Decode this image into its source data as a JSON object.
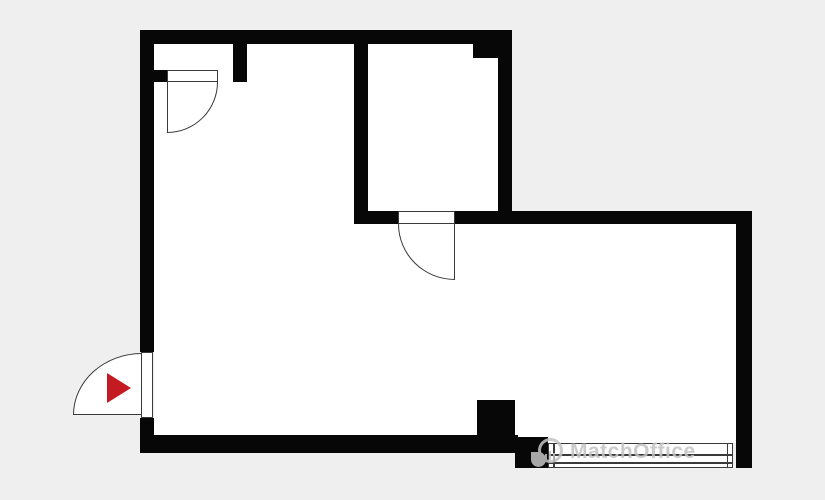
{
  "page": {
    "type": "floor-plan",
    "title": "apartment floor plan"
  },
  "plan": {
    "background_color": "#efefef",
    "wall_color": "#070707",
    "floor_color": "#ffffff",
    "line_color": "#3a3a3a",
    "entrance_marker_color": "#c41a22",
    "watermark_color": "#c3c3c3",
    "rooms": [
      {
        "name": "main-room",
        "shape": "L-shaped open space"
      },
      {
        "name": "small-room",
        "shape": "rectangular, top middle"
      },
      {
        "name": "entry-niche",
        "shape": "recess in top-left wall"
      }
    ],
    "doors": [
      {
        "name": "niche-door",
        "hinge": "top-left",
        "swing": "down-right"
      },
      {
        "name": "small-room-door",
        "hinge": "top-right",
        "swing": "down-left"
      },
      {
        "name": "entrance-door",
        "hinge": "bottom-right",
        "swing": "outward-left"
      }
    ],
    "window": {
      "name": "window",
      "position": "bottom-right wall"
    },
    "entrance_marker": {
      "icon": "red-arrow-right-icon"
    }
  },
  "watermark": {
    "text": "MatchOffice",
    "logo": "map-pin-logo-icon"
  }
}
